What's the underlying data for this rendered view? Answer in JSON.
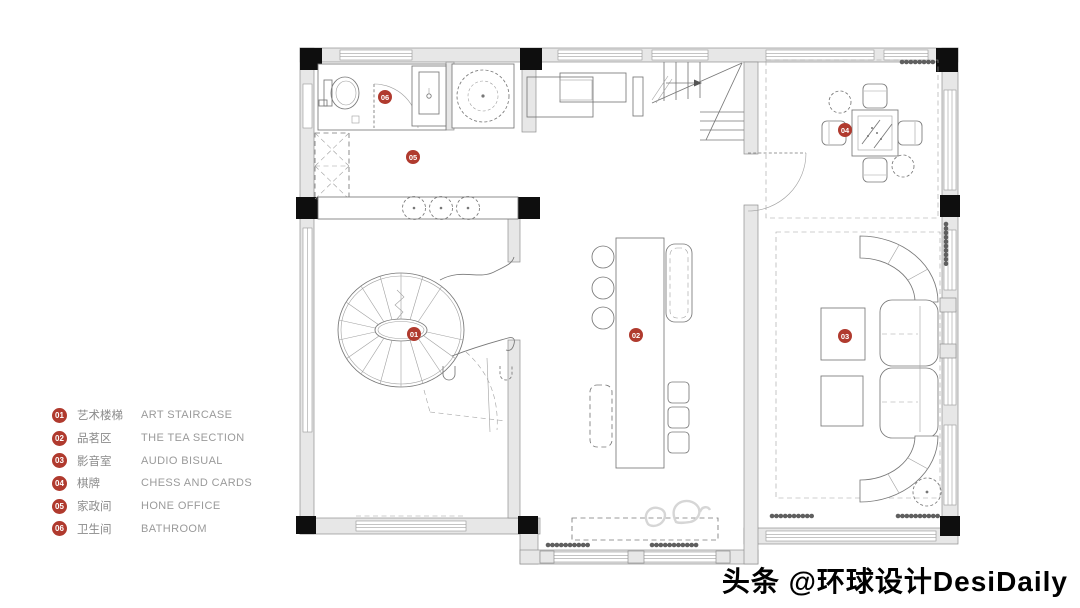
{
  "legend": {
    "badge_color": "#b03a2e",
    "items": [
      {
        "num": "01",
        "cn": "艺术楼梯",
        "en": "ART STAIRCASE",
        "marker_x": 414,
        "marker_y": 334
      },
      {
        "num": "02",
        "cn": "品茗区",
        "en": "THE TEA SECTION",
        "marker_x": 636,
        "marker_y": 335
      },
      {
        "num": "03",
        "cn": "影音室",
        "en": "AUDIO BISUAL",
        "marker_x": 845,
        "marker_y": 336
      },
      {
        "num": "04",
        "cn": "棋牌",
        "en": "CHESS AND CARDS",
        "marker_x": 845,
        "marker_y": 130
      },
      {
        "num": "05",
        "cn": "家政间",
        "en": "HONE OFFICE",
        "marker_x": 413,
        "marker_y": 157
      },
      {
        "num": "06",
        "cn": "卫生间",
        "en": "BATHROOM",
        "marker_x": 385,
        "marker_y": 97
      }
    ]
  },
  "watermark": {
    "text": "头条 @环球设计DesiDaily"
  }
}
